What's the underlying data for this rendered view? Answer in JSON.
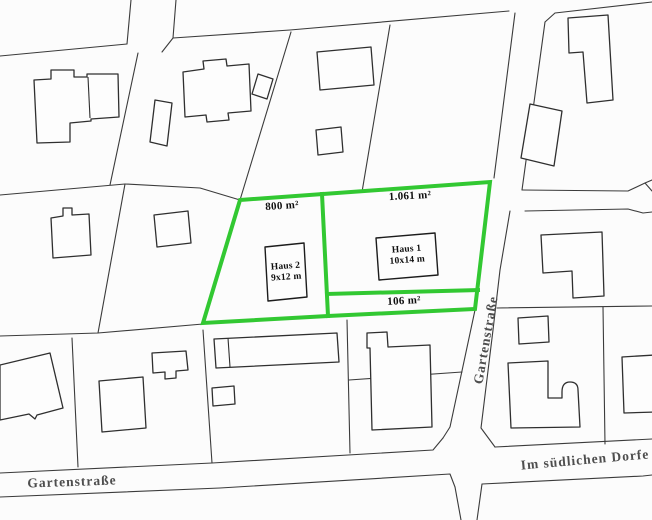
{
  "colors": {
    "highlight": "#32c832",
    "line": "#3b3b3b",
    "building": "#2f2f2f",
    "street_text": "#4e4e4e",
    "label_text": "#101010",
    "paper": "#fcfcfc"
  },
  "parcels": {
    "left": {
      "area_label": "800 m²"
    },
    "right": {
      "area_label": "1.061 m²"
    },
    "strip": {
      "area_label": "106 m²"
    }
  },
  "houses": {
    "haus2": {
      "name": "Haus 2",
      "dimensions": "9x12 m"
    },
    "haus1": {
      "name": "Haus 1",
      "dimensions": "10x14 m"
    }
  },
  "streets": {
    "gartenstrasse_vertical": "Gartenstraße",
    "gartenstrasse_bottom": "Gartenstraße",
    "im_suedlichen_dorfe": "Im südlichen Dorfe"
  }
}
